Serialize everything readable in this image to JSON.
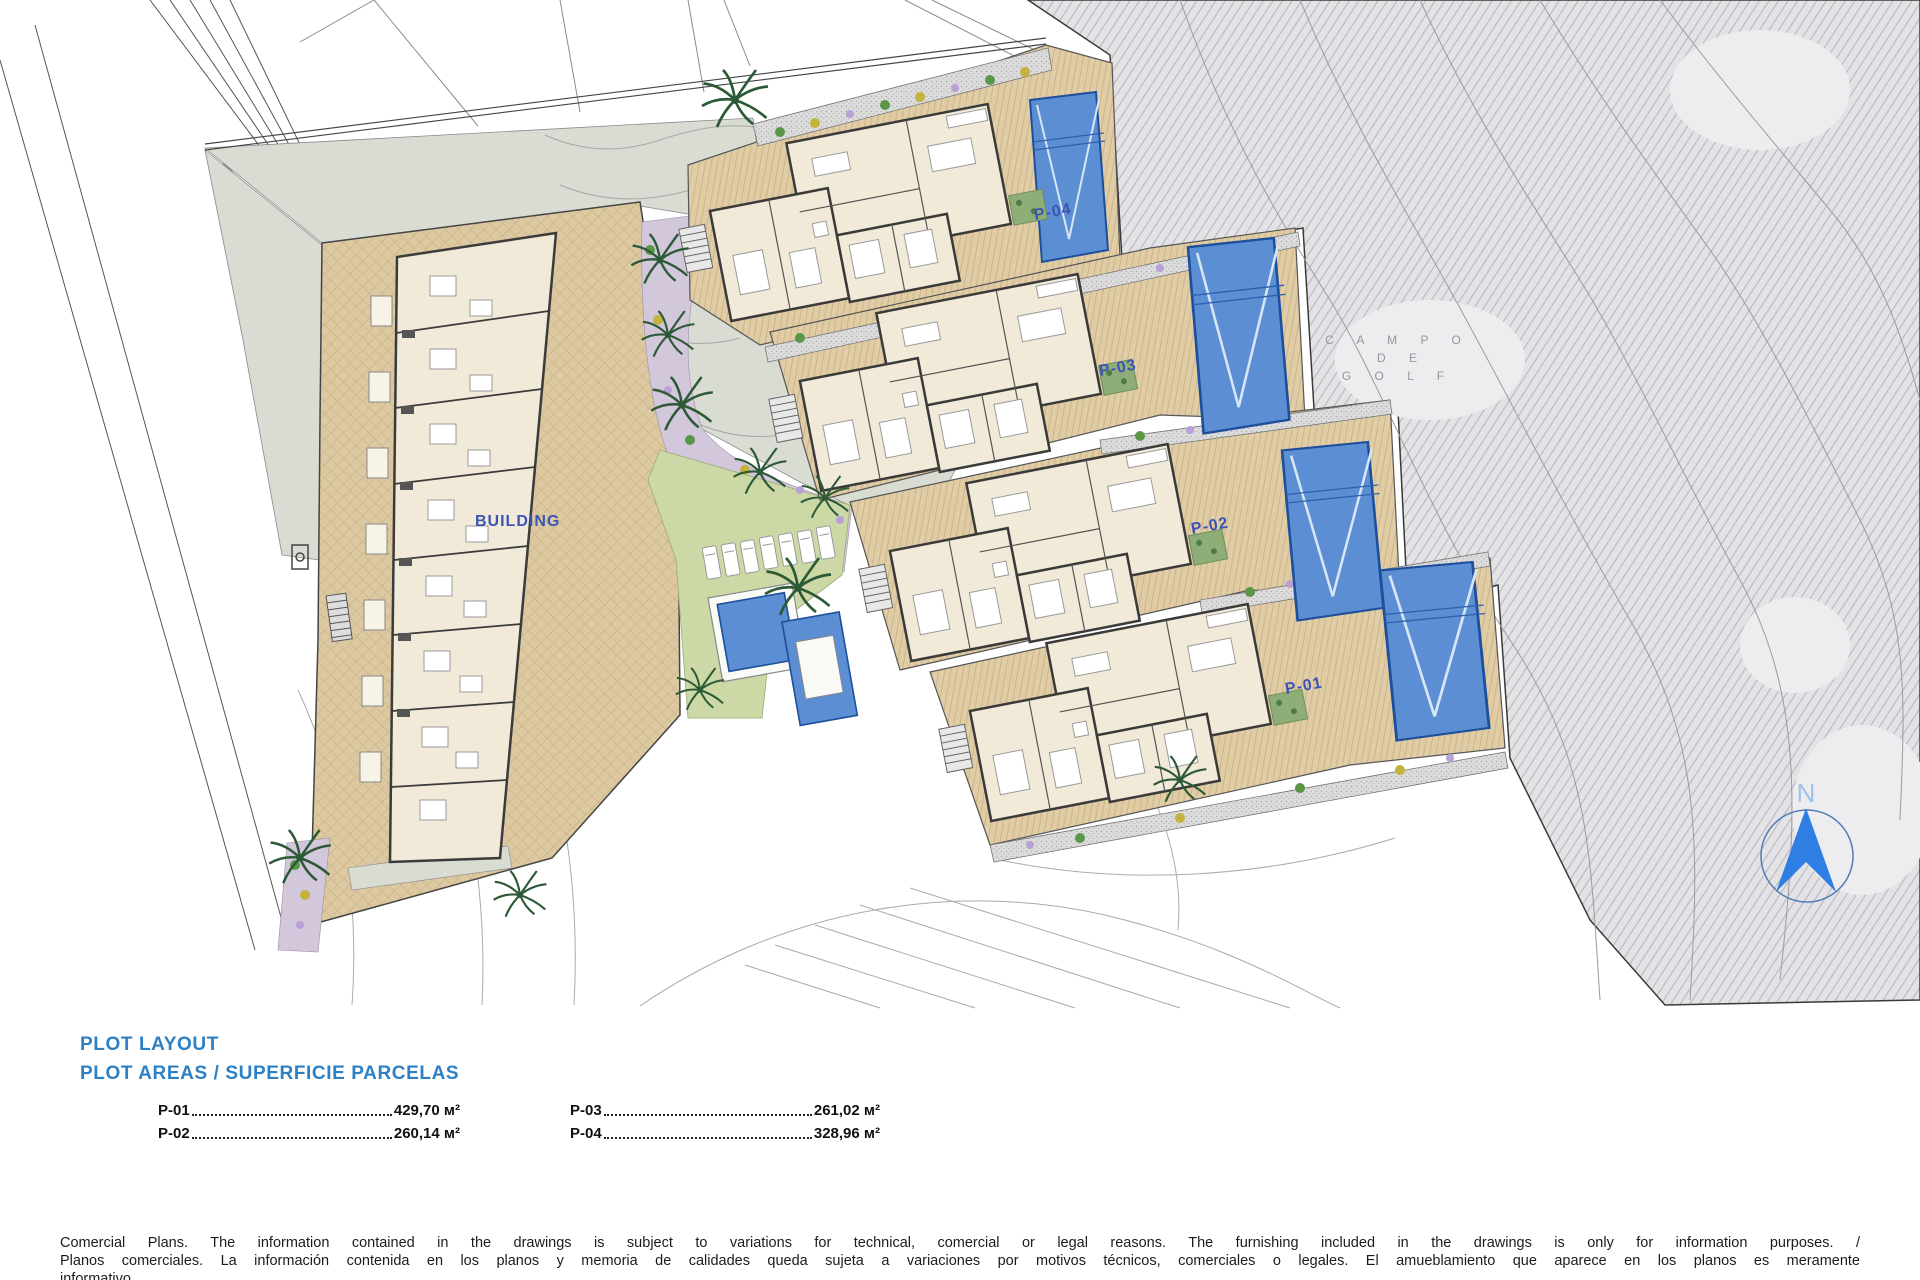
{
  "plan": {
    "building_label": "BUILDING",
    "plots": [
      {
        "id": "p04",
        "label": "P-04"
      },
      {
        "id": "p03",
        "label": "P-03"
      },
      {
        "id": "p02",
        "label": "P-02"
      },
      {
        "id": "p01",
        "label": "P-01"
      }
    ],
    "golf_label_lines": [
      "C A M P O",
      "D E",
      "G O L F"
    ],
    "compass_label": "N"
  },
  "legend": {
    "title": "PLOT LAYOUT",
    "subtitle": "PLOT AREAS / SUPERFICIE PARCELAS",
    "areas": [
      {
        "plot": "P-01",
        "value": "429,70 м²"
      },
      {
        "plot": "P-02",
        "value": "260,14 м²"
      },
      {
        "plot": "P-03",
        "value": "261,02 м²"
      },
      {
        "plot": "P-04",
        "value": "328,96 м²"
      }
    ]
  },
  "disclaimer": {
    "line1": "Comercial Plans. The information contained in the drawings is subject to variations for technical, comercial or legal reasons. The furnishing included in the drawings is only for information purposes. /",
    "line2": "Planos comerciales. La información contenida en los planos y memoria de calidades queda sujeta a variaciones por motivos técnicos, comerciales o legales. El amueblamiento que aparece en los planos es meramente",
    "line3": "informativo."
  },
  "colors": {
    "heading_blue": "#2e80c4",
    "plot_label_blue": "#3c55b5",
    "pool_blue": "#5b8ed2",
    "paving_tan": "#dcc9a1",
    "lawn_green": "#ccd9a6",
    "golf_gray": "#e3e3e6"
  }
}
